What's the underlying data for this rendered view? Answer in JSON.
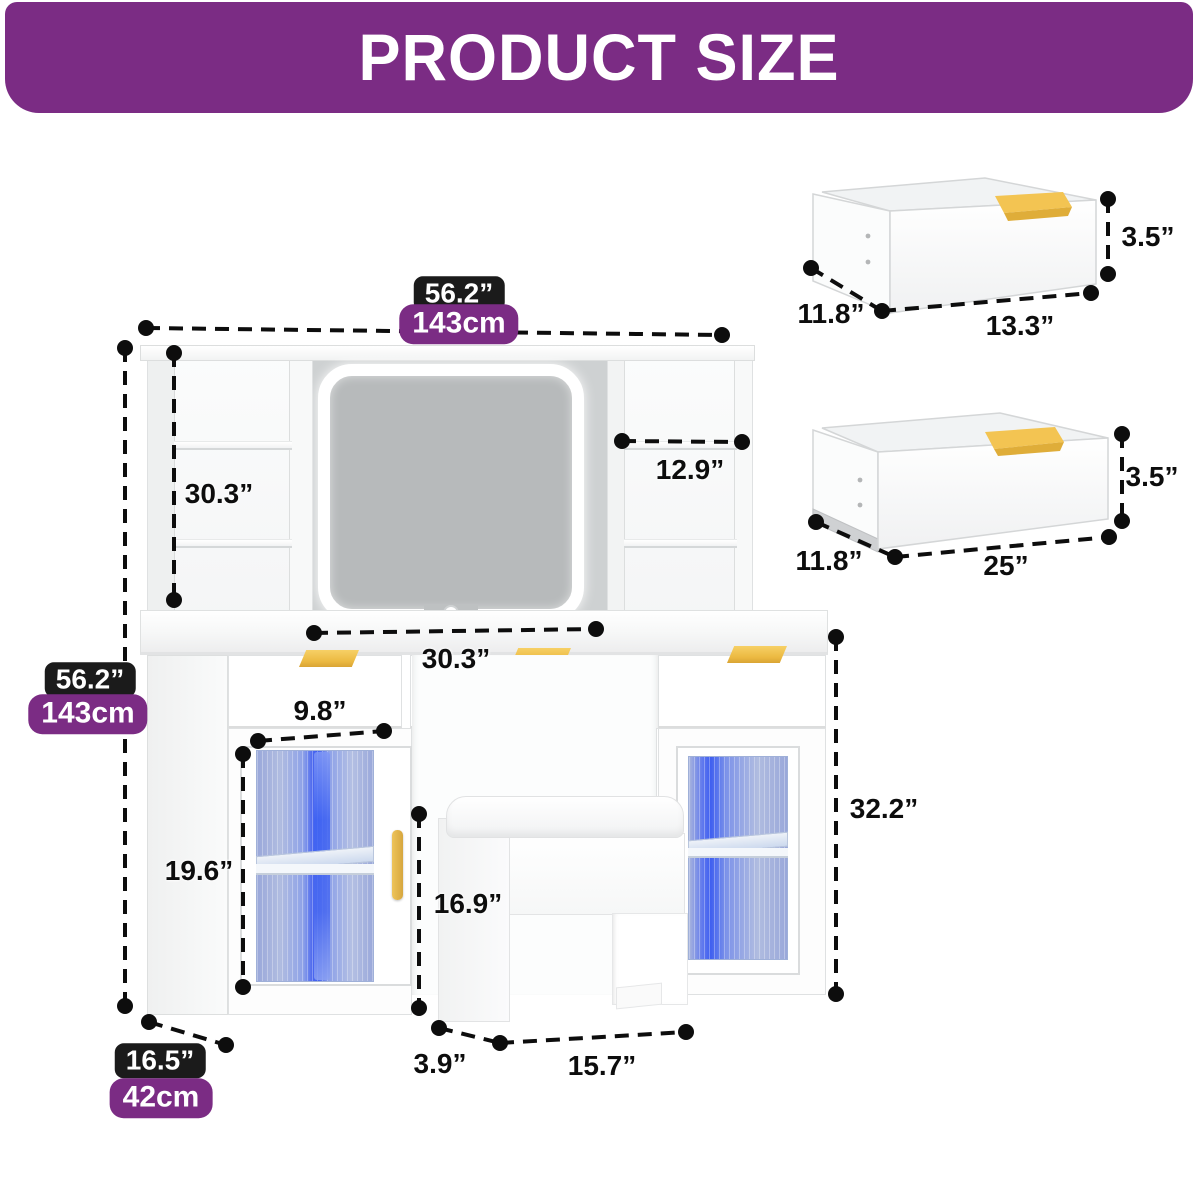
{
  "header": {
    "title": "PRODUCT SIZE"
  },
  "colors": {
    "banner_purple": "#7b2c84",
    "badge_black": "#1b1b1b",
    "badge_purple": "#7b2c84",
    "handle_gold": "#ecba42",
    "led_blue": "#3f5ff0",
    "mirror_gray": "#b7babb"
  },
  "vanity": {
    "overall_width": {
      "inches": "56.2”",
      "cm": "143cm"
    },
    "overall_height": {
      "inches": "56.2”",
      "cm": "143cm"
    },
    "depth": {
      "inches": "16.5”",
      "cm": "42cm"
    },
    "hutch_shelf_height": "30.3”",
    "right_shelf_width": "12.9”",
    "mirror_width": "30.3”",
    "cabinet_door_width": "9.8”",
    "cabinet_door_height": "19.6”",
    "tabletop_height": "32.2”"
  },
  "stool": {
    "height": "16.9”",
    "seat_depth": "3.9”",
    "width": "15.7”"
  },
  "small_drawer": {
    "height": "3.5”",
    "depth": "11.8”",
    "width": "13.3”"
  },
  "large_drawer": {
    "height": "3.5”",
    "depth": "11.8”",
    "width": "25”"
  }
}
